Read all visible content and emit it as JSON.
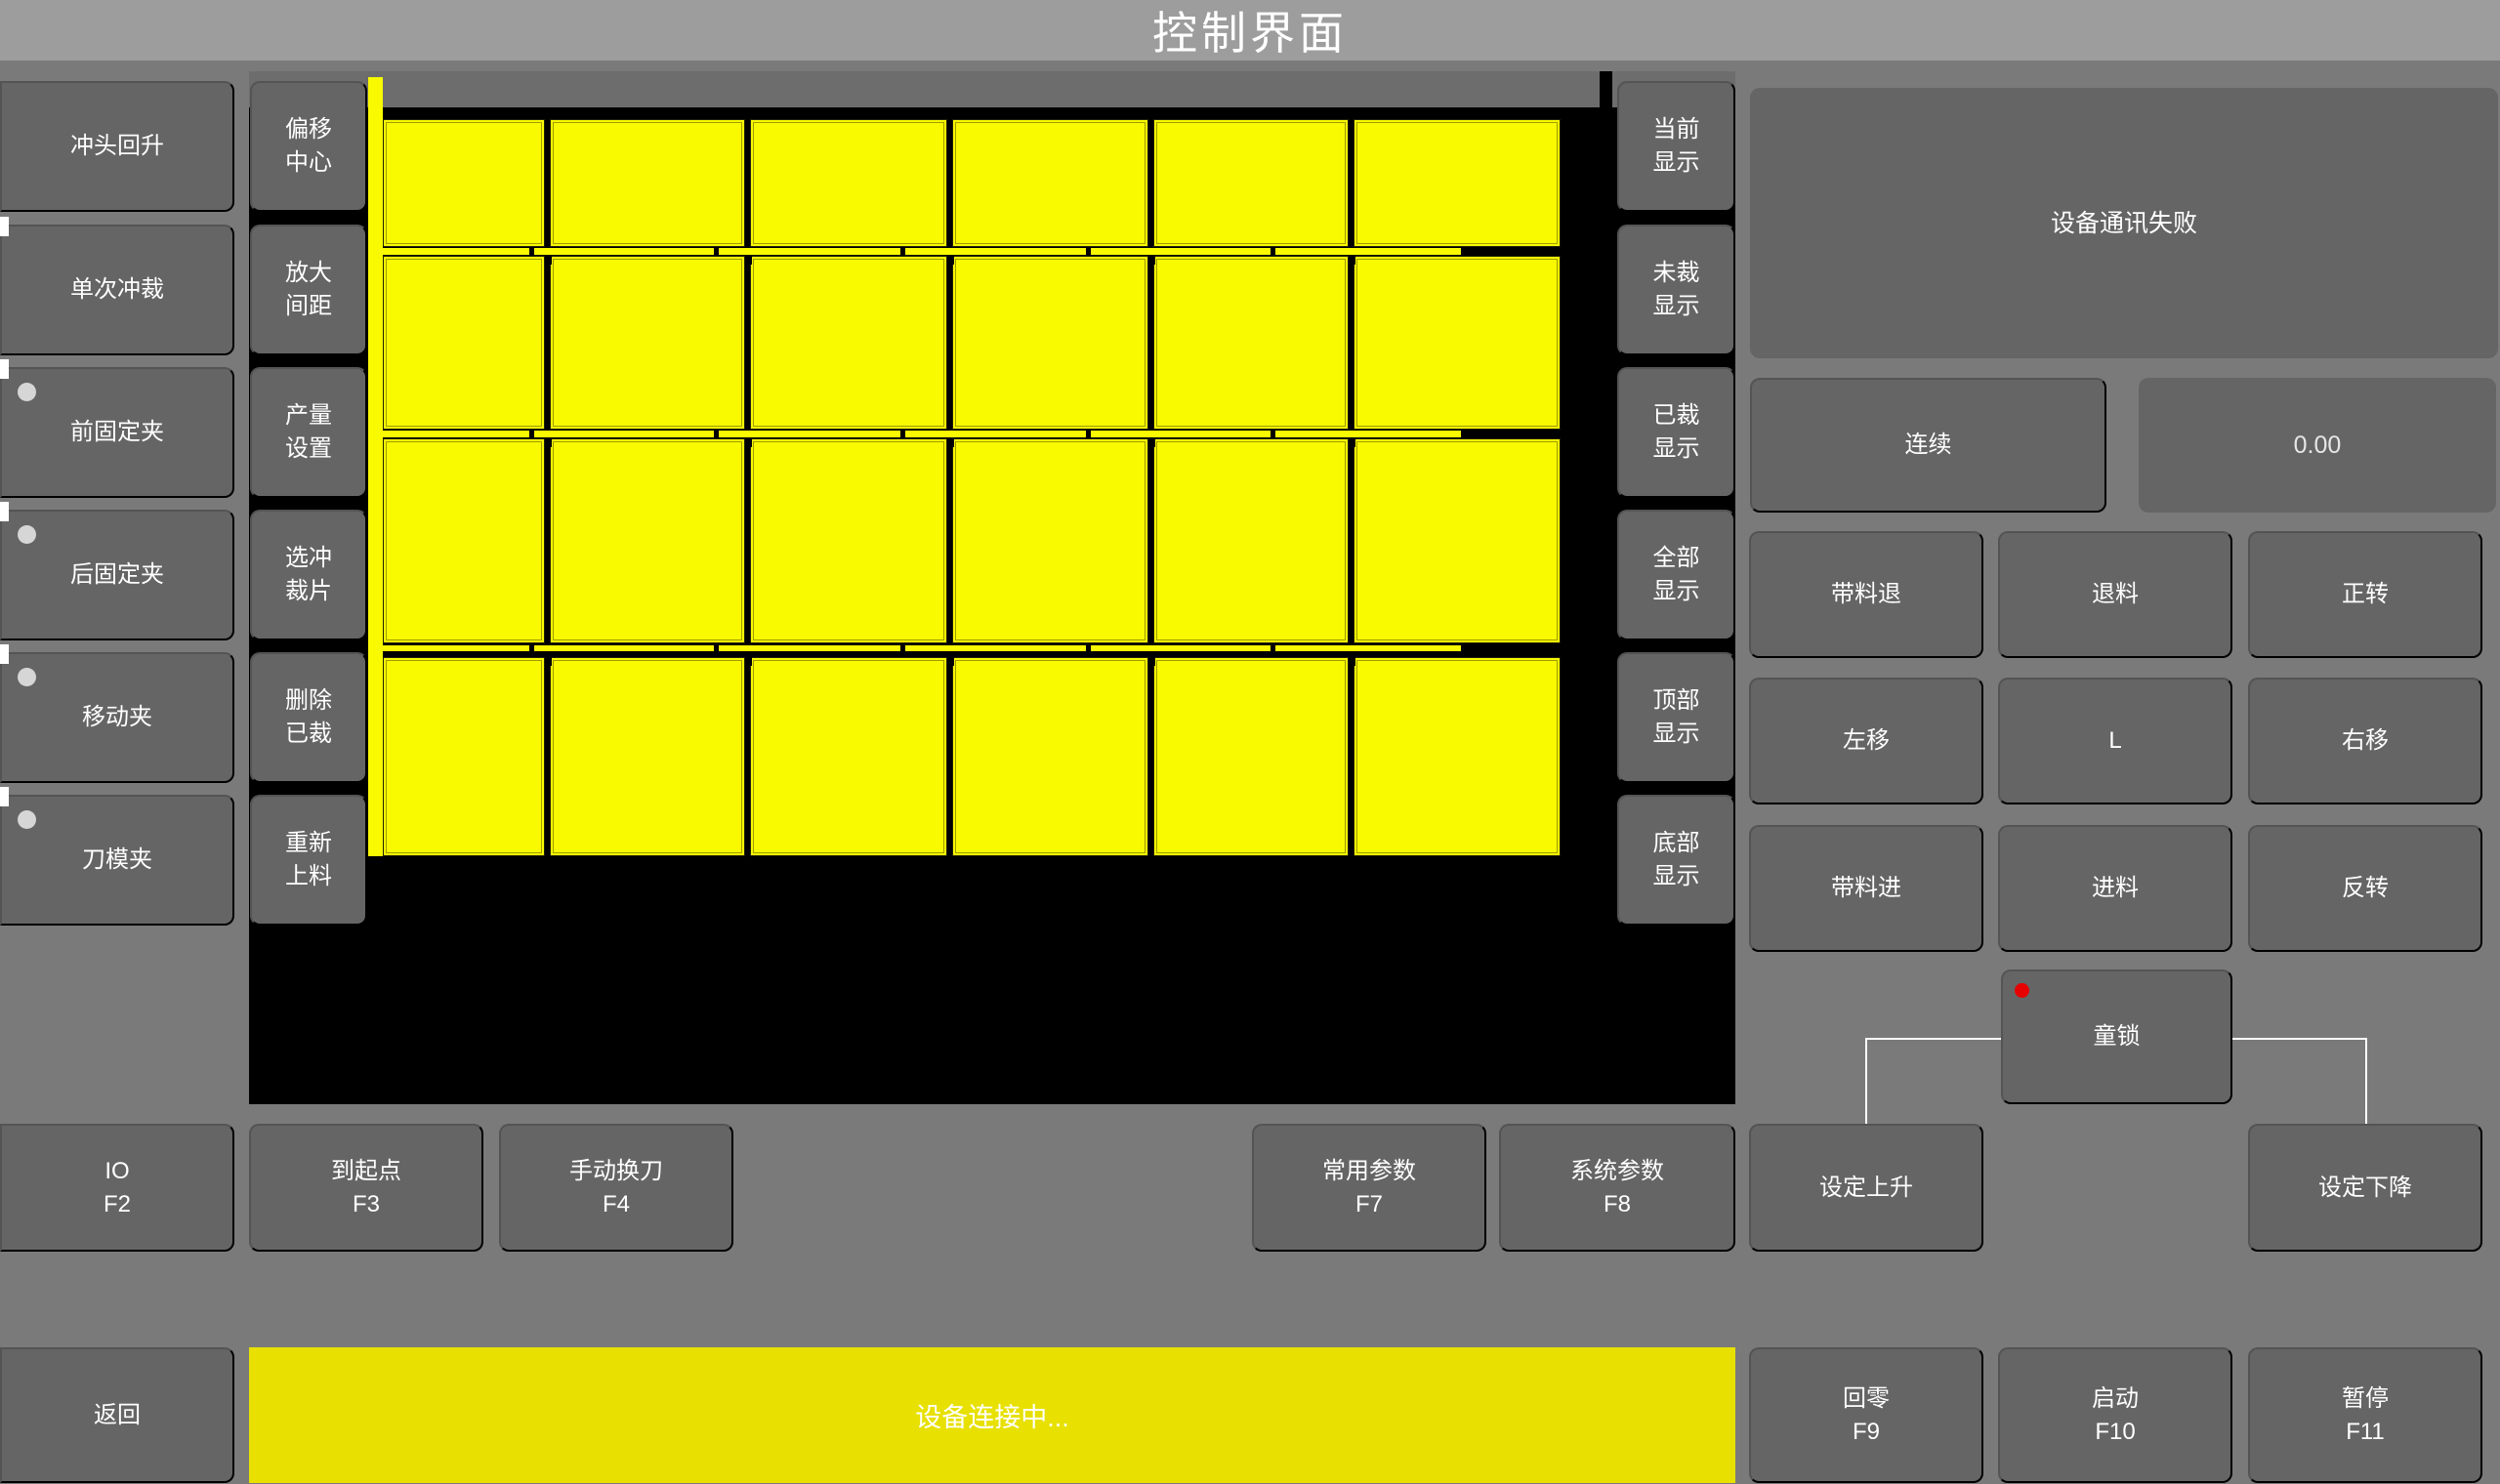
{
  "title": "控制界面",
  "left_buttons": [
    {
      "label": "冲头回升",
      "indicator": false
    },
    {
      "label": "单次冲裁",
      "indicator": false
    },
    {
      "label": "前固定夹",
      "indicator": true
    },
    {
      "label": "后固定夹",
      "indicator": true
    },
    {
      "label": "移动夹",
      "indicator": true
    },
    {
      "label": "刀模夹",
      "indicator": true
    }
  ],
  "tool_buttons": [
    "偏移\n中心",
    "放大\n间距",
    "产量\n设置",
    "选冲\n裁片",
    "删除\n已裁",
    "重新\n上料"
  ],
  "display_buttons": [
    "当前\n显示",
    "未裁\n显示",
    "已裁\n显示",
    "全部\n显示",
    "顶部\n显示",
    "底部\n显示"
  ],
  "piece_grid": {
    "rows": 4,
    "cols": 6,
    "piece_color": "#f9f900",
    "background": "#000000"
  },
  "right_panel": {
    "alert_message": "设备通讯失败",
    "mode_button": "连续",
    "value_display": "0.00",
    "jog_buttons": [
      "带料退",
      "退料",
      "正转",
      "左移",
      "L",
      "右移",
      "带料进",
      "进料",
      "反转"
    ],
    "child_lock": "童锁"
  },
  "function_row": [
    {
      "label": "IO",
      "key": "F2"
    },
    {
      "label": "到起点",
      "key": "F3"
    },
    {
      "label": "手动换刀",
      "key": "F4"
    },
    {
      "label": "常用参数",
      "key": "F7"
    },
    {
      "label": "系统参数",
      "key": "F8"
    },
    {
      "label": "设定上升",
      "key": ""
    },
    {
      "label": "设定下降",
      "key": ""
    }
  ],
  "bottom_bar": {
    "back": "返回",
    "status": "设备连接中...",
    "keys": [
      {
        "label": "回零",
        "key": "F9"
      },
      {
        "label": "启动",
        "key": "F10"
      },
      {
        "label": "暂停",
        "key": "F11"
      }
    ]
  },
  "colors": {
    "piece_yellow": "#f9f900",
    "status_bar_yellow": "#e7e000",
    "alert_dot_red": "#e60000",
    "button_gray": "#656565",
    "titlebar_gray": "#9d9d9d"
  }
}
